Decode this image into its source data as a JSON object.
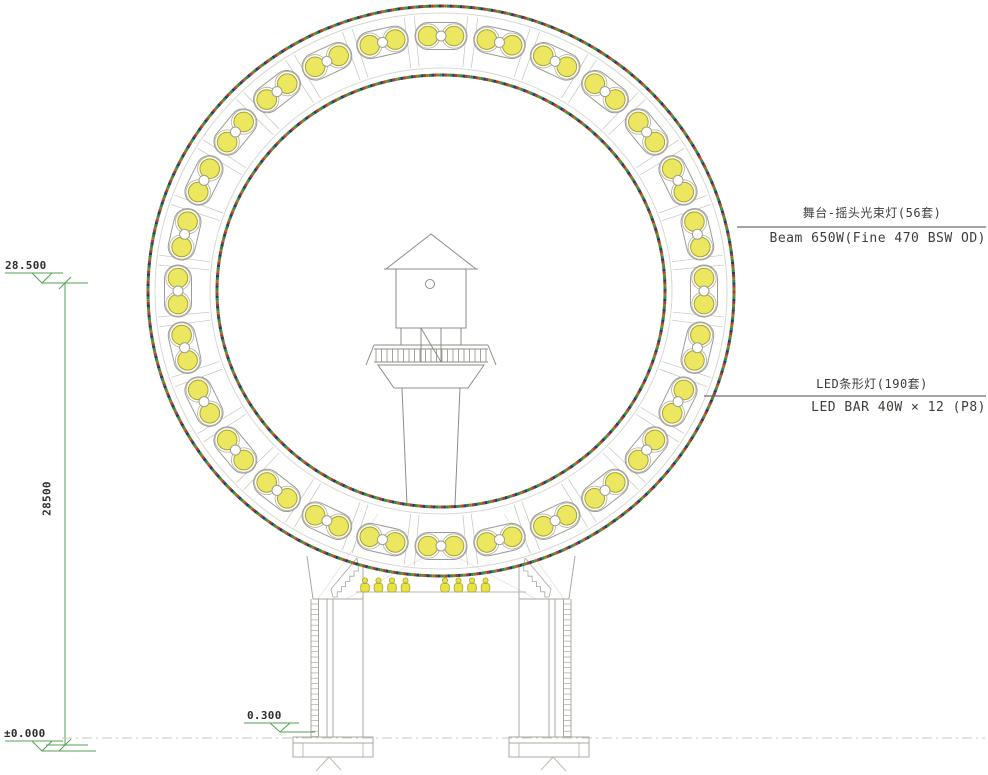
{
  "annotations": {
    "beam_light": {
      "zh": "舞台-摇头光束灯(56套)",
      "en": "Beam 650W(Fine 470 BSW OD)"
    },
    "led_bar": {
      "zh": "LED条形灯(190套)",
      "en": "LED BAR 40W × 12 (P8)"
    }
  },
  "dimensions": {
    "top_level": "28.500",
    "overall_height": "28500",
    "ground_level": "±0.000",
    "platform_level": "0.300"
  },
  "ring": {
    "fixture_capsules": 28,
    "lamps_per_capsule": 2
  },
  "base": {
    "stage_mini_lights": 8
  },
  "colors": {
    "dimension_green": "#55a055",
    "structure_gray": "#9c9c94",
    "faint_gray": "#d8d8d2",
    "dark_line": "#4a4a46",
    "lamp_yellow": "#e8e345",
    "lamp_yellow_stroke": "#a8a32c",
    "led_dot_colors": [
      "#b8322b",
      "#1d3d6e",
      "#2e8b3d",
      "#8a7c20"
    ]
  }
}
